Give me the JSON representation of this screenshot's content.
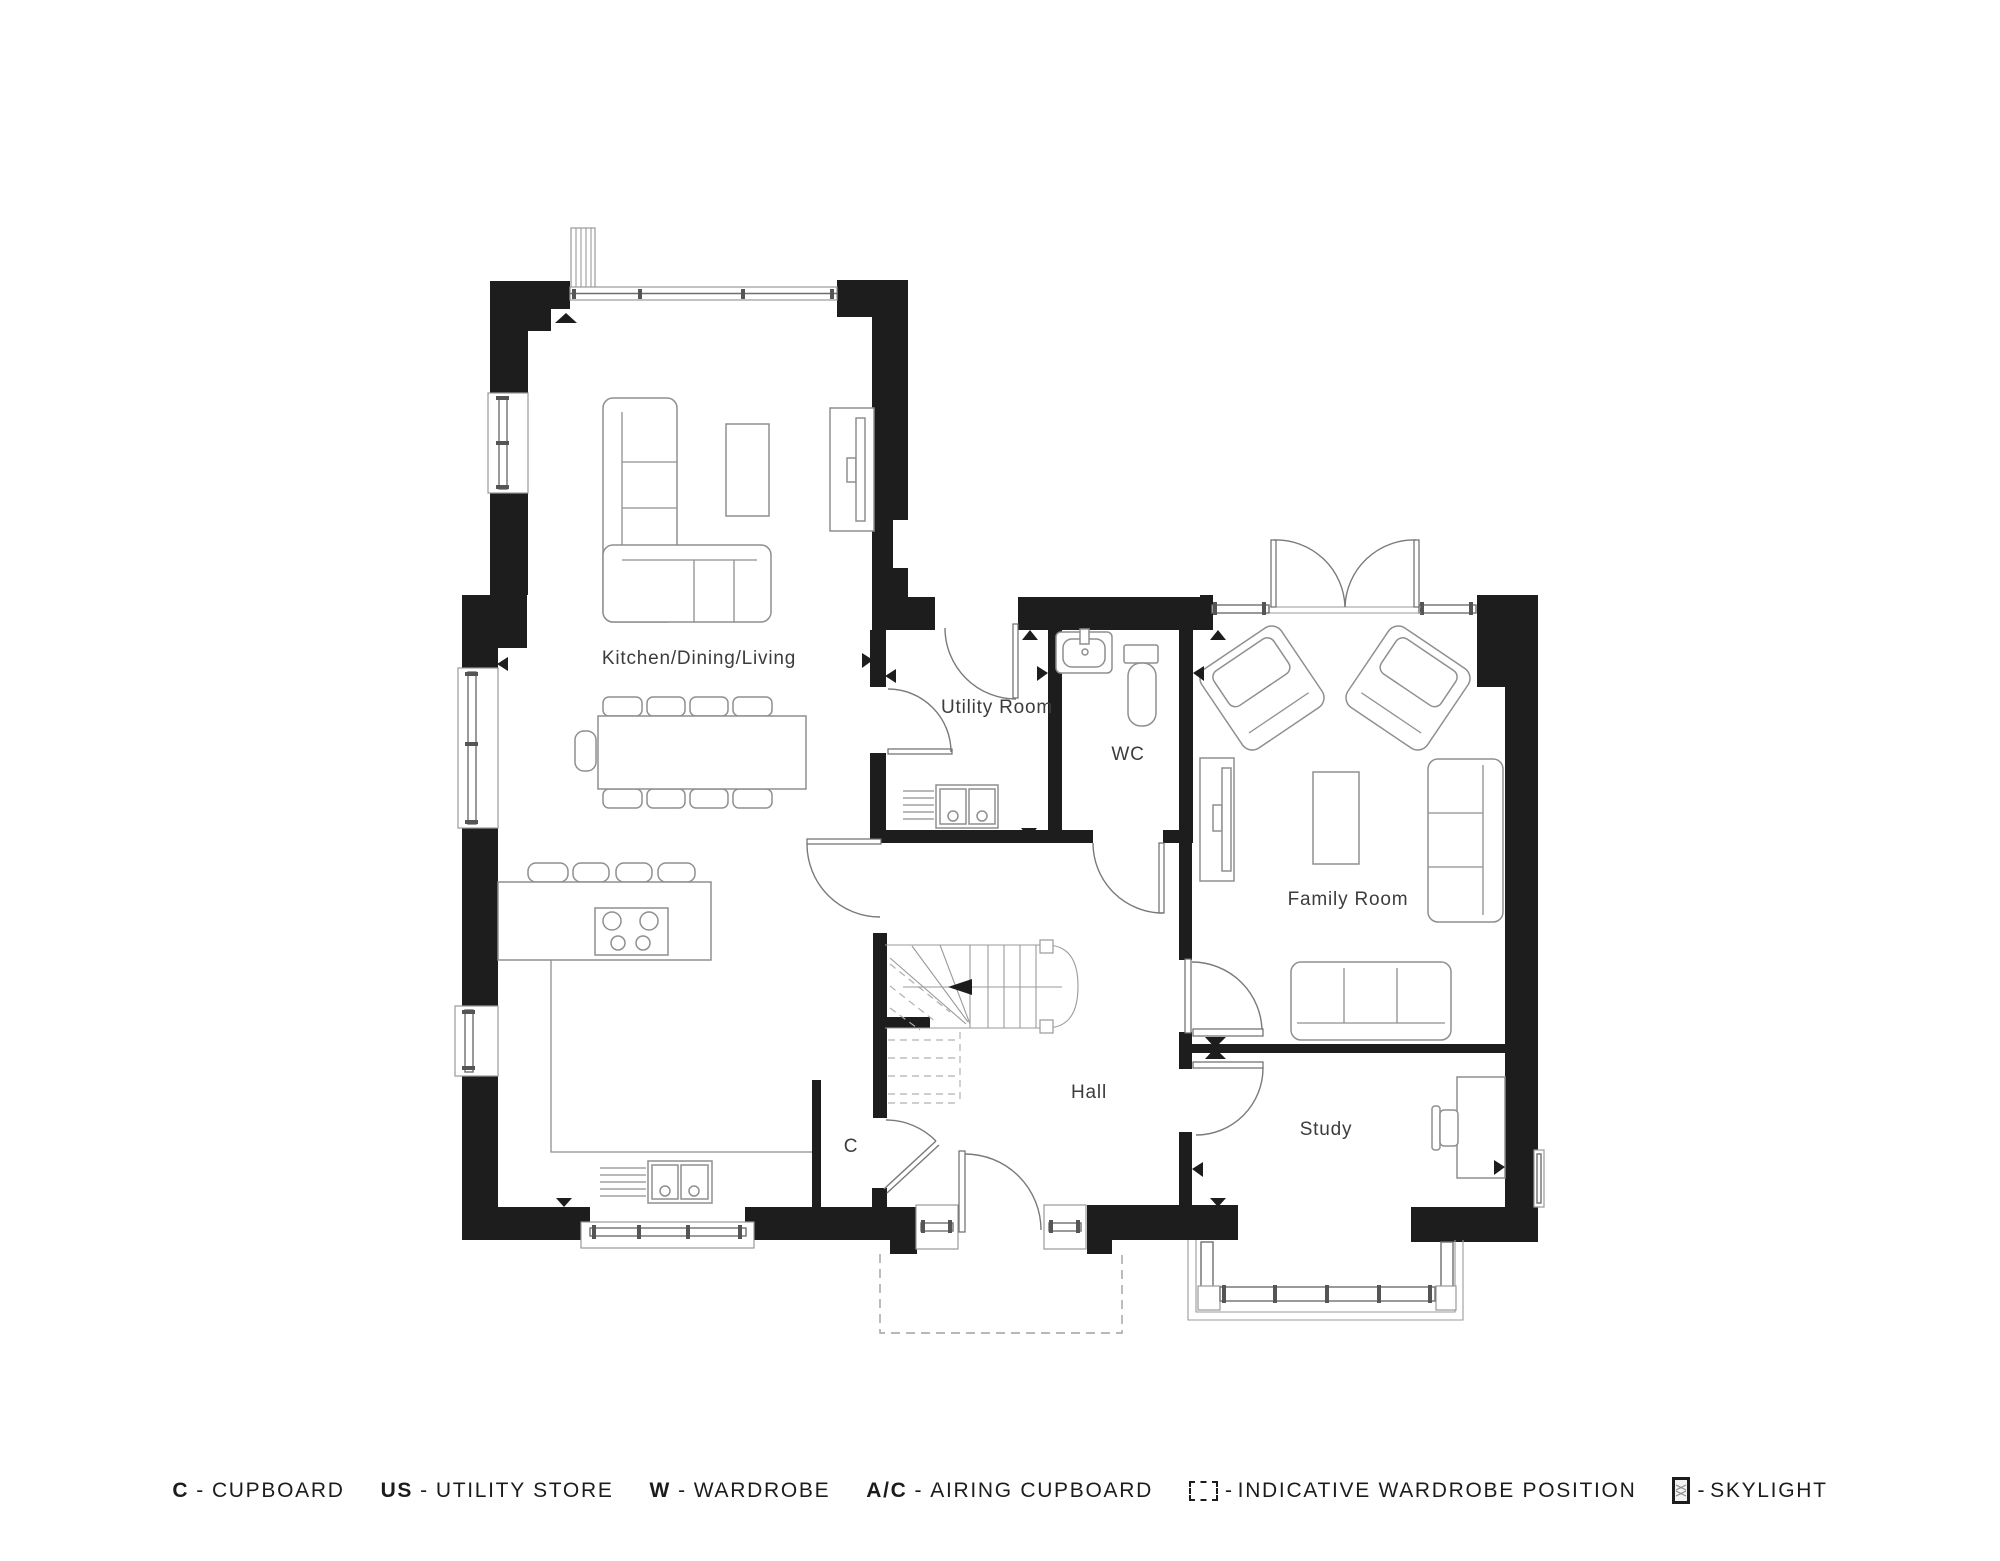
{
  "plan": {
    "rooms": {
      "kitchen": {
        "label": "Kitchen/Dining/Living"
      },
      "utility": {
        "label": "Utility Room"
      },
      "wc": {
        "label": "WC"
      },
      "family": {
        "label": "Family Room"
      },
      "hall": {
        "label": "Hall"
      },
      "study": {
        "label": "Study"
      },
      "cupboard": {
        "label": "C"
      }
    }
  },
  "legend": {
    "separator": "-",
    "items": [
      {
        "key": "C",
        "label": "CUPBOARD"
      },
      {
        "key": "US",
        "label": "UTILITY STORE"
      },
      {
        "key": "W",
        "label": "WARDROBE"
      },
      {
        "key": "A/C",
        "label": "AIRING CUPBOARD"
      },
      {
        "icon": "wardrobe-position-icon",
        "label": "INDICATIVE WARDROBE POSITION"
      },
      {
        "icon": "skylight-icon",
        "label": "SKYLIGHT"
      }
    ]
  },
  "colors": {
    "wall": "#1d1d1d",
    "line": "#8f8f8f",
    "text": "#3c3c3e",
    "background": "#ffffff"
  }
}
